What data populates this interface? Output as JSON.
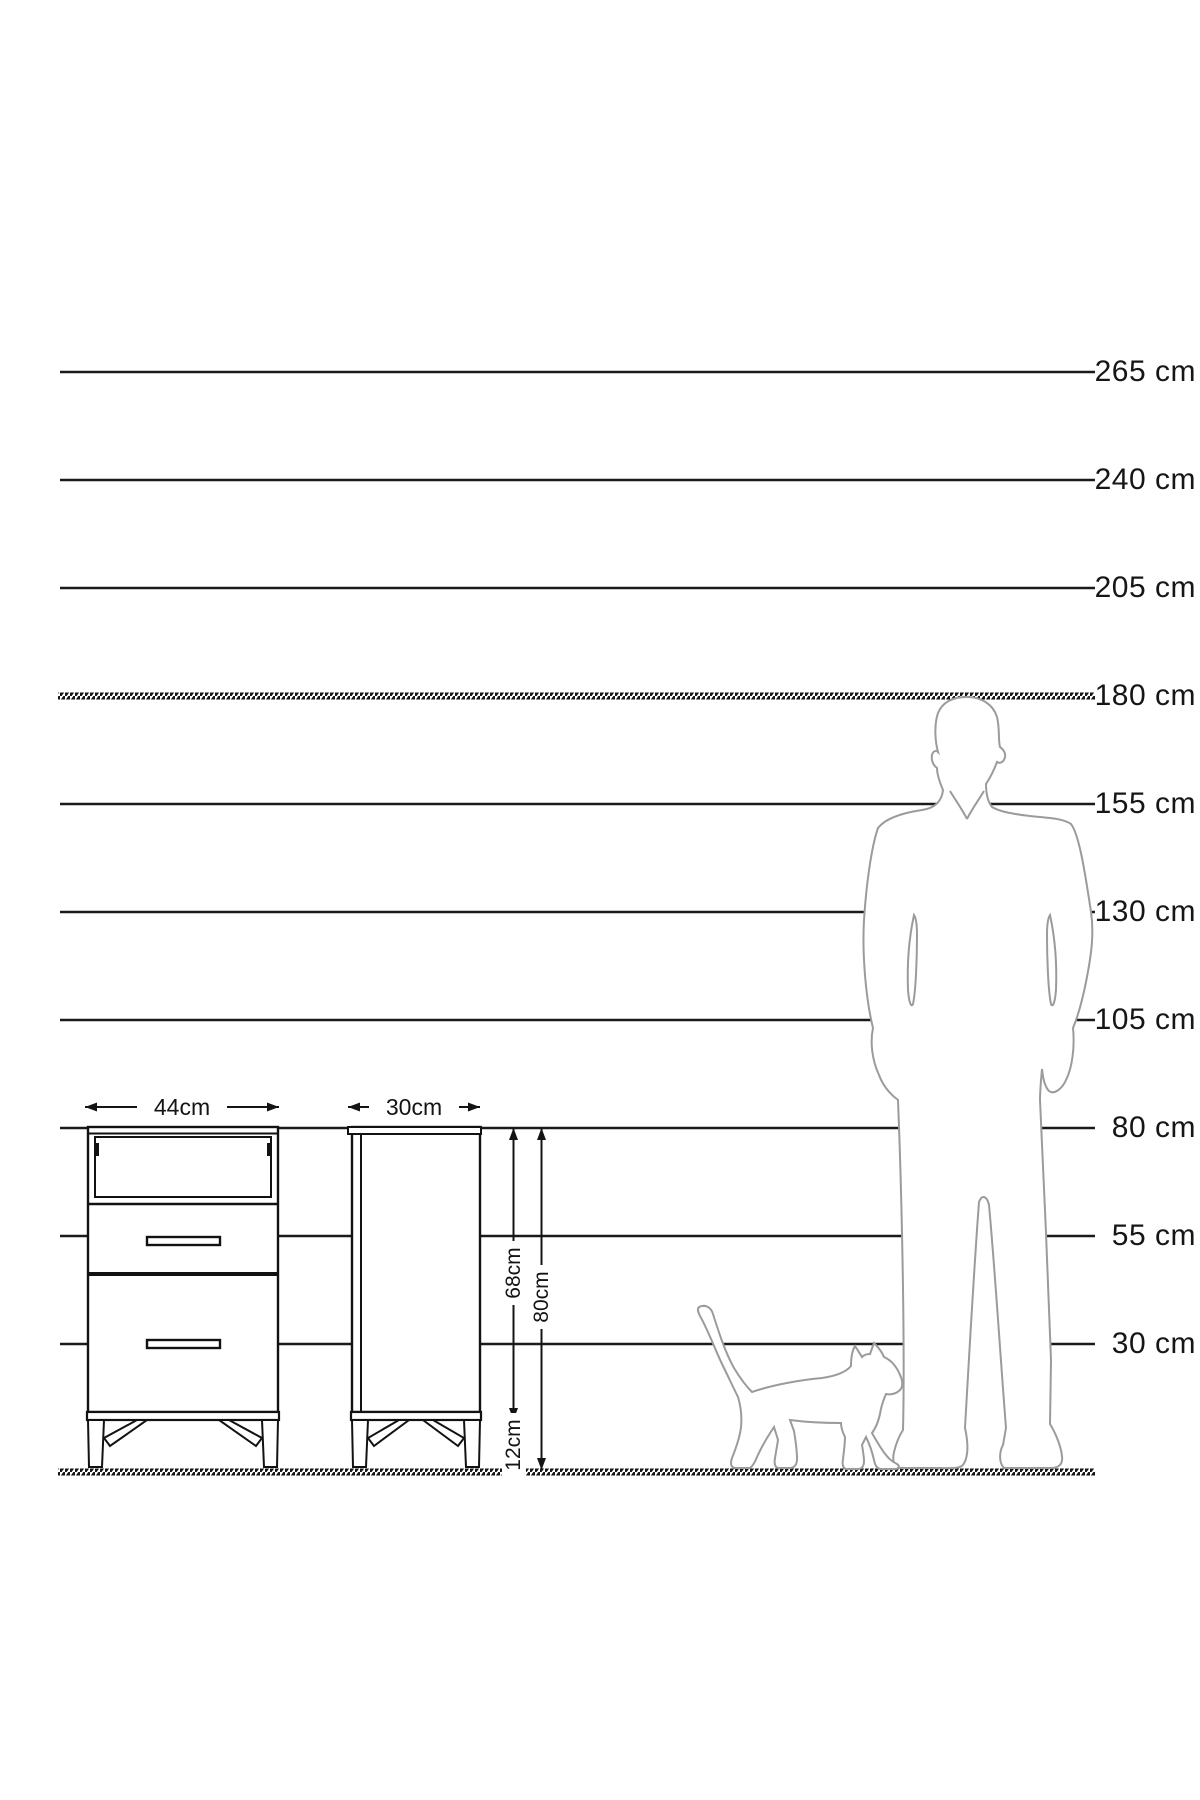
{
  "page": {
    "background": "#ffffff"
  },
  "colors": {
    "ruler_line": "#1a1a1a",
    "furniture_line": "#121212",
    "silhouette_line": "#9b9b9b",
    "text": "#161616",
    "background": "#ffffff"
  },
  "ruler": {
    "unit": "cm",
    "line_start_x": 60,
    "line_end_x": 1095,
    "label_right_x": 1196,
    "floor_y": 1472,
    "lines": [
      {
        "label": "265 cm",
        "y": 372,
        "hatched": false
      },
      {
        "label": "240 cm",
        "y": 480,
        "hatched": false
      },
      {
        "label": "205 cm",
        "y": 588,
        "hatched": false
      },
      {
        "label": "180 cm",
        "y": 696,
        "hatched": true
      },
      {
        "label": "155 cm",
        "y": 804,
        "hatched": false
      },
      {
        "label": "130 cm",
        "y": 912,
        "hatched": false
      },
      {
        "label": "105 cm",
        "y": 1020,
        "hatched": false
      },
      {
        "label": "80 cm",
        "y": 1128,
        "hatched": false
      },
      {
        "label": "55 cm",
        "y": 1236,
        "hatched": false
      },
      {
        "label": "30 cm",
        "y": 1344,
        "hatched": false
      }
    ]
  },
  "dimensions": {
    "front_width": "44cm",
    "side_depth": "30cm",
    "body_height": "68cm",
    "total_height": "80cm",
    "leg_height": "12cm"
  }
}
